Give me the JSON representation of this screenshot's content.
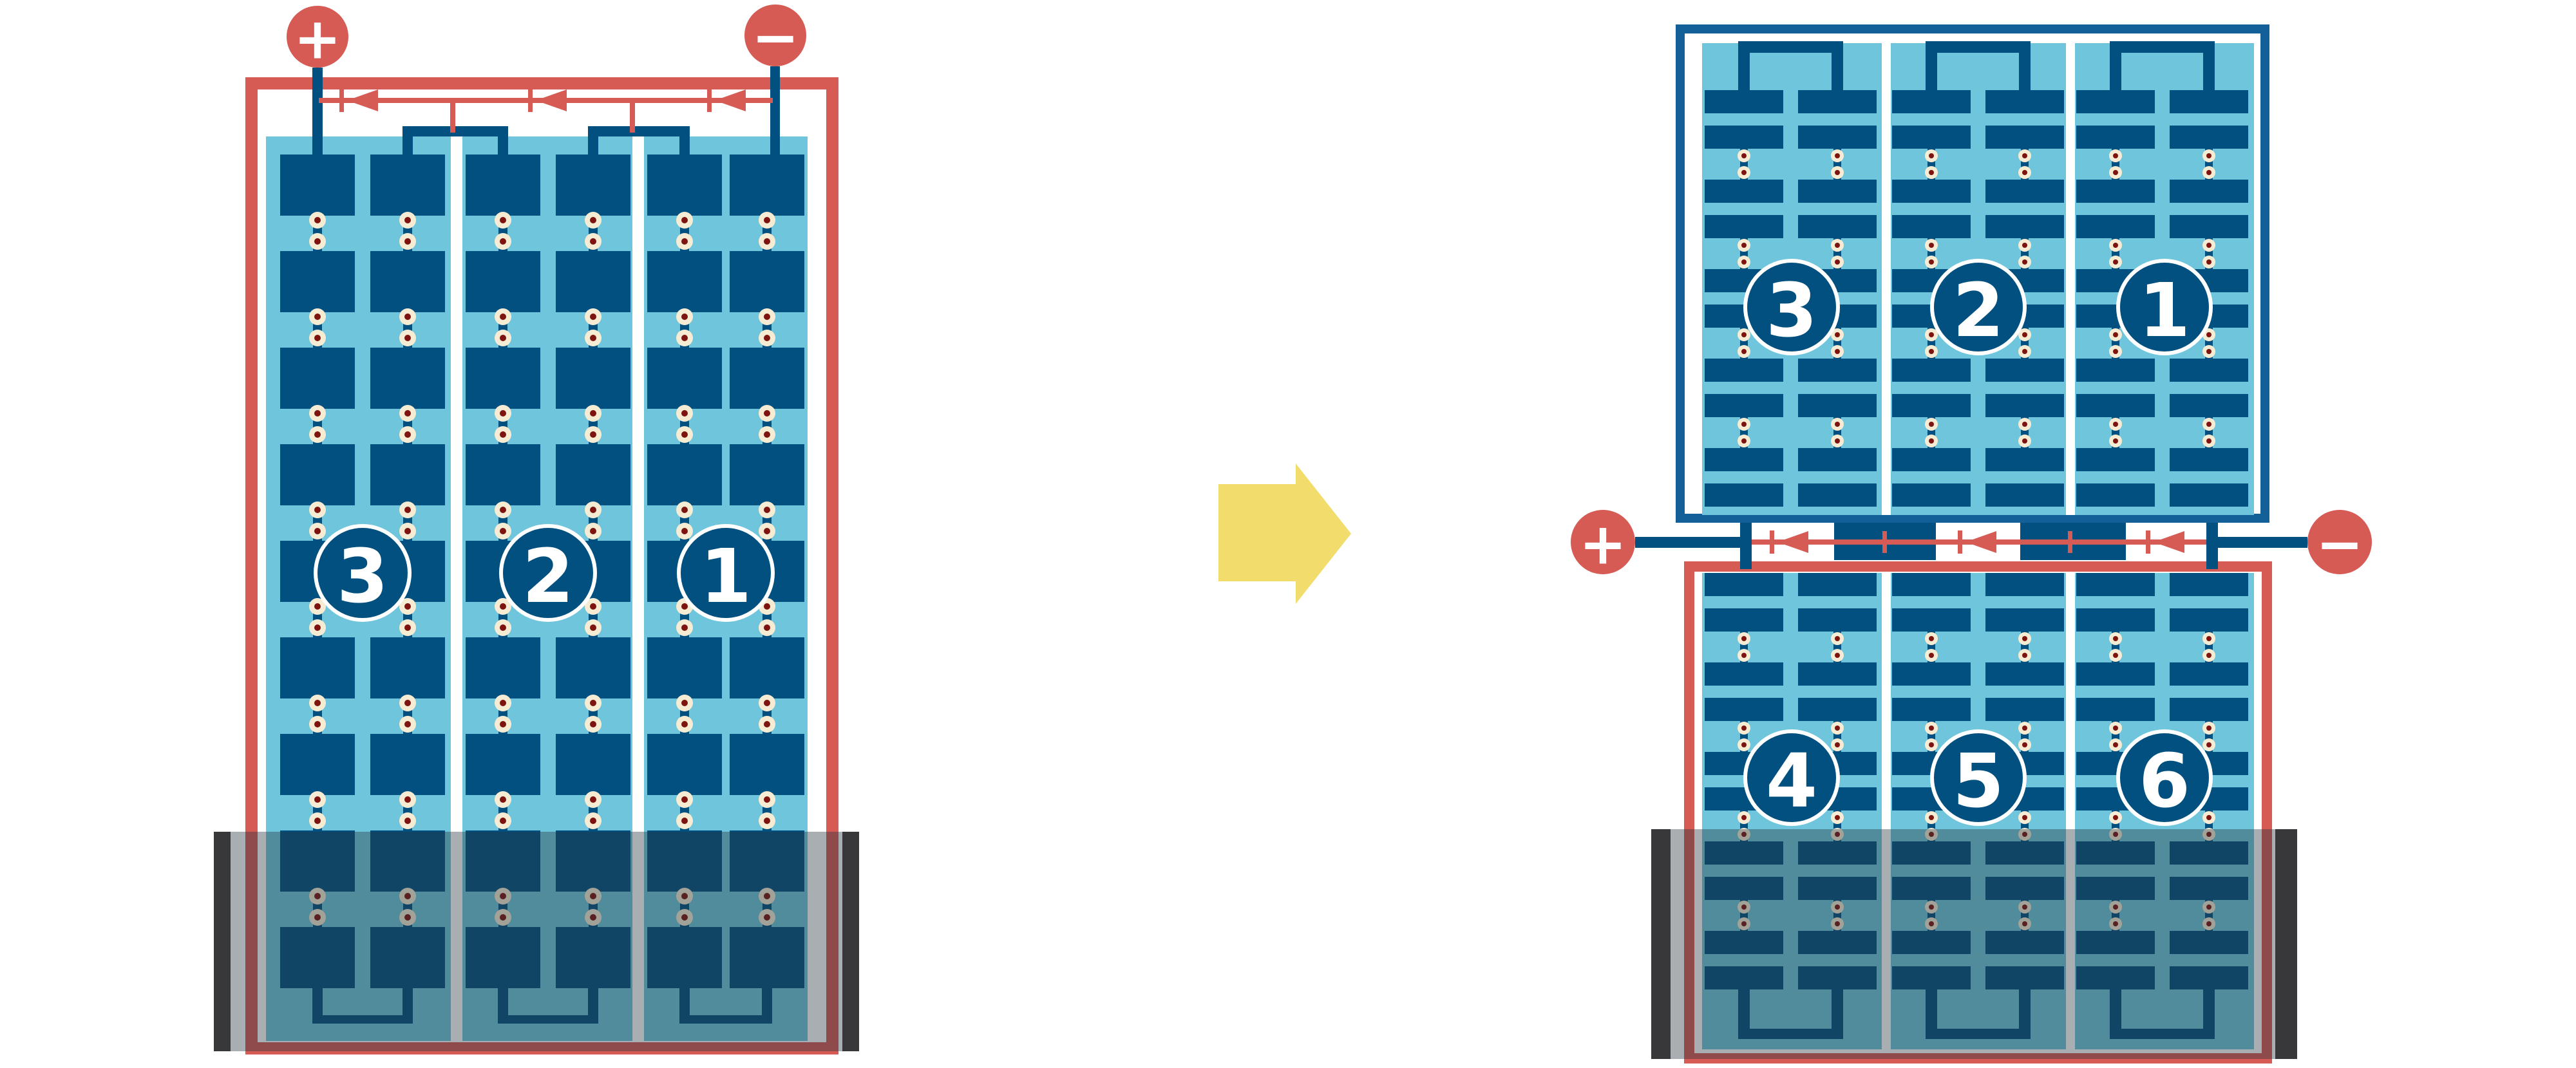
{
  "colors": {
    "red": "#D65B55",
    "cell_blue": "#02507F",
    "frame_blue": "#135F97",
    "light_blue": "#6FC6DC",
    "solder_cream": "#F6ECD4",
    "solder_dot_red": "#7E1410",
    "arrow_yellow": "#F2DC6B",
    "shade_bar_dark": "#38383A",
    "shade_overlay": "rgba(38,52,62,0.40)"
  },
  "left_panel": {
    "string_labels": [
      "3",
      "2",
      "1"
    ],
    "positive_terminal": "+",
    "negative_terminal": "−"
  },
  "right_top_panel": {
    "string_labels": [
      "3",
      "2",
      "1"
    ]
  },
  "right_bottom_panel": {
    "string_labels": [
      "4",
      "5",
      "6"
    ]
  },
  "junction": {
    "positive_terminal": "+",
    "negative_terminal": "−"
  }
}
